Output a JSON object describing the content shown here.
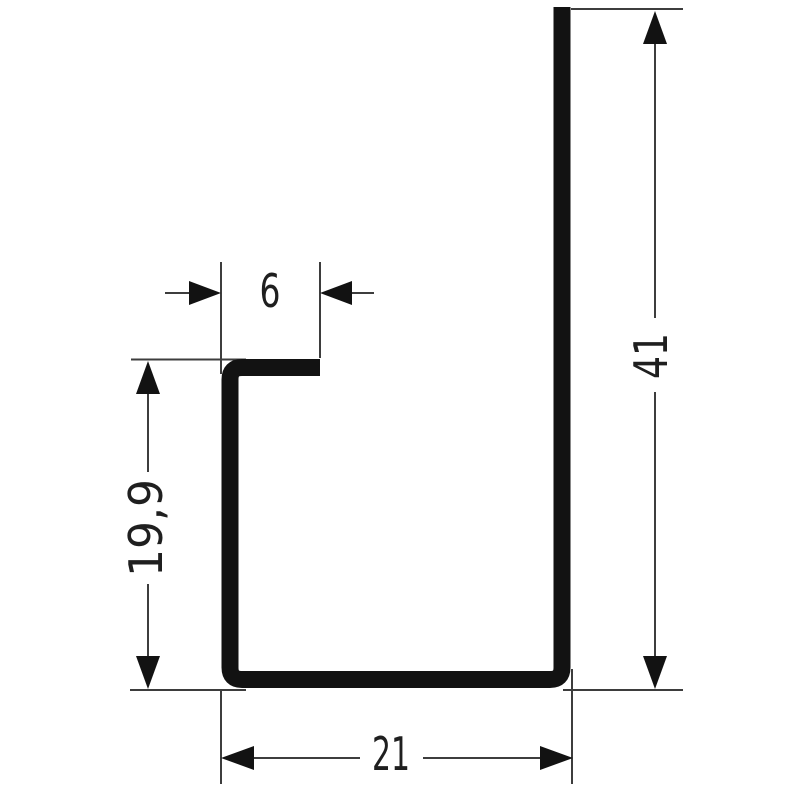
{
  "diagram": {
    "background": "#ffffff",
    "ink_color": "#121212",
    "thin_line_color": "#3d3d3d",
    "text_color": "#1f1f1f",
    "dimensions": {
      "flange_width": "6",
      "overall_height": "41",
      "leg_height": "19,9",
      "overall_width": "21"
    }
  }
}
